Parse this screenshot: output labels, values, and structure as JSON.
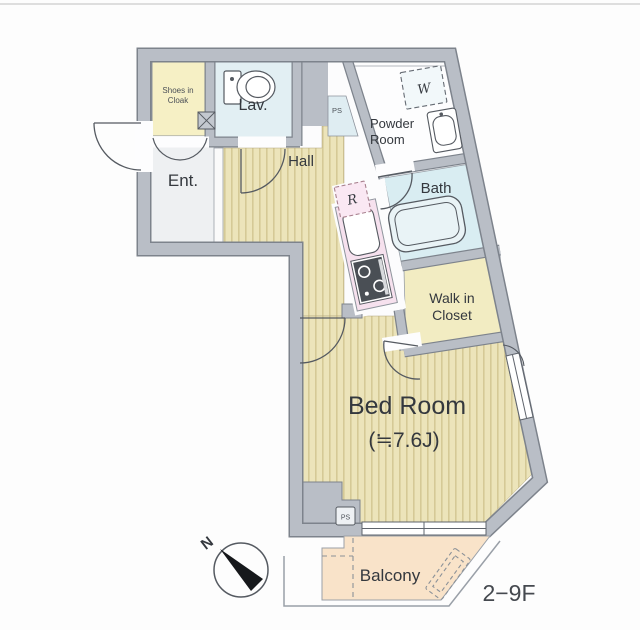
{
  "plan": {
    "rooms": {
      "shoes_cloak": {
        "line1": "Shoes in",
        "line2": "Cloak"
      },
      "lavatory": {
        "label": "Lav."
      },
      "entrance": {
        "label": "Ent."
      },
      "hall": {
        "label": "Hall"
      },
      "powder": {
        "line1": "Powder",
        "line2": "Room"
      },
      "bath": {
        "label": "Bath"
      },
      "walk_in_closet": {
        "line1": "Walk in",
        "line2": "Closet"
      },
      "bedroom": {
        "label": "Bed Room",
        "size": "(≒7.6J)"
      },
      "balcony": {
        "label": "Balcony"
      }
    },
    "fixtures": {
      "washer": "W",
      "refrigerator": "R",
      "pipe_space_upper": "PS",
      "pipe_space_lower": "PS"
    },
    "compass": {
      "north_label": "N"
    },
    "floor_range": "2−9F",
    "colors": {
      "wall": "#b9bec6",
      "wall_edge": "#7d838c",
      "wood_floor": "#ece4ba",
      "wood_stripe": "#d5c996",
      "water_blue": "#dcedf3",
      "closet_yellow": "#f4eec6",
      "kitchen_pink": "#f6e1ee",
      "balcony_peach": "#f9e3c9"
    }
  }
}
